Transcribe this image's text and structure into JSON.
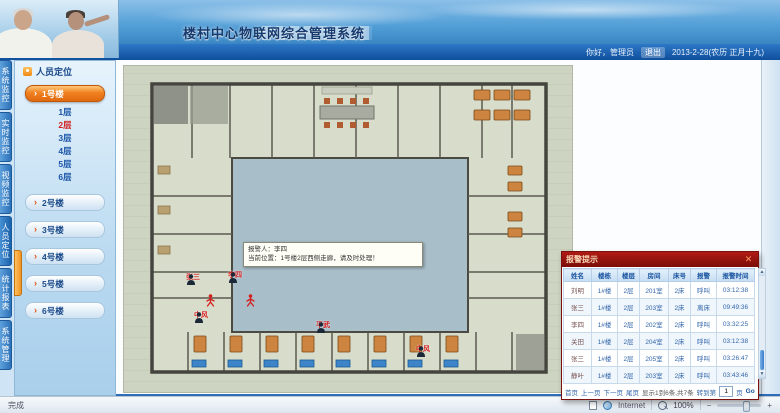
{
  "header": {
    "title": "楼村中心物联网综合管理系统"
  },
  "userbar": {
    "greeting": "你好，管理员",
    "logout_label": "退出",
    "date": "2013-2-28(农历 正月十九)"
  },
  "sidebar": {
    "arrow_icon": "›",
    "tabs": [
      {
        "label": "系统监控",
        "active": false
      },
      {
        "label": "实时监控",
        "active": false
      },
      {
        "label": "视频监控",
        "active": false
      },
      {
        "label": "人员定位",
        "active": true
      },
      {
        "label": "统计报表",
        "active": false
      },
      {
        "label": "系统管理",
        "active": false
      }
    ],
    "panel_title": "人员定位",
    "buildings": [
      {
        "label": "1号楼",
        "active": true
      },
      {
        "label": "2号楼",
        "active": false
      },
      {
        "label": "3号楼",
        "active": false
      },
      {
        "label": "4号楼",
        "active": false
      },
      {
        "label": "5号楼",
        "active": false
      },
      {
        "label": "6号楼",
        "active": false
      }
    ],
    "floors": [
      {
        "label": "1层",
        "active": false
      },
      {
        "label": "2层",
        "active": true
      },
      {
        "label": "3层",
        "active": false
      },
      {
        "label": "4层",
        "active": false
      },
      {
        "label": "5层",
        "active": false
      },
      {
        "label": "6层",
        "active": false
      }
    ]
  },
  "plan": {
    "tooltip": {
      "line1": "报警人：李四",
      "line2": "当前位置：1号楼2层西侧走廊，请及时处理！"
    },
    "markers": [
      {
        "type": "person",
        "x": 62,
        "y": 208,
        "label": "张三"
      },
      {
        "type": "person",
        "x": 104,
        "y": 206,
        "label": "李四"
      },
      {
        "type": "alert",
        "x": 82,
        "y": 228,
        "label": ""
      },
      {
        "type": "alert",
        "x": 122,
        "y": 228,
        "label": ""
      },
      {
        "type": "person",
        "x": 70,
        "y": 246,
        "label": "中风"
      },
      {
        "type": "person",
        "x": 192,
        "y": 256,
        "label": "平武"
      },
      {
        "type": "person",
        "x": 292,
        "y": 280,
        "label": "中风"
      }
    ]
  },
  "alert_popup": {
    "title": "报警提示",
    "close_icon": "✕",
    "columns": [
      "姓名",
      "楼栋",
      "楼层",
      "房间",
      "床号",
      "报警",
      "报警时间"
    ],
    "rows": [
      [
        "刘明",
        "1#楼",
        "2层",
        "201室",
        "2床",
        "呼叫",
        "03:12:38"
      ],
      [
        "张三",
        "1#楼",
        "2层",
        "203室",
        "2床",
        "离床",
        "09:49:36"
      ],
      [
        "李四",
        "1#楼",
        "2层",
        "202室",
        "2床",
        "呼叫",
        "03:32:25"
      ],
      [
        "关田",
        "1#楼",
        "2层",
        "204室",
        "2床",
        "呼叫",
        "03:12:38"
      ],
      [
        "张三",
        "1#楼",
        "2层",
        "205室",
        "2床",
        "呼叫",
        "03:26:47"
      ],
      [
        "静叶",
        "1#楼",
        "2层",
        "203室",
        "2床",
        "呼叫",
        "03:43:46"
      ]
    ],
    "scroll_up_icon": "▲",
    "scroll_down_icon": "▼",
    "pagination": {
      "links": [
        "首页",
        "上一页",
        "下一页",
        "尾页"
      ],
      "info": "显示1到6条,共7条",
      "goto_label": "转到第",
      "page_value": "1",
      "unit_label": "页",
      "go_label": "Go"
    }
  },
  "statusbar": {
    "left": "完成",
    "zone": "Internet",
    "zoom_out": "−",
    "zoom_level": "100%",
    "zoom_in": "+"
  }
}
